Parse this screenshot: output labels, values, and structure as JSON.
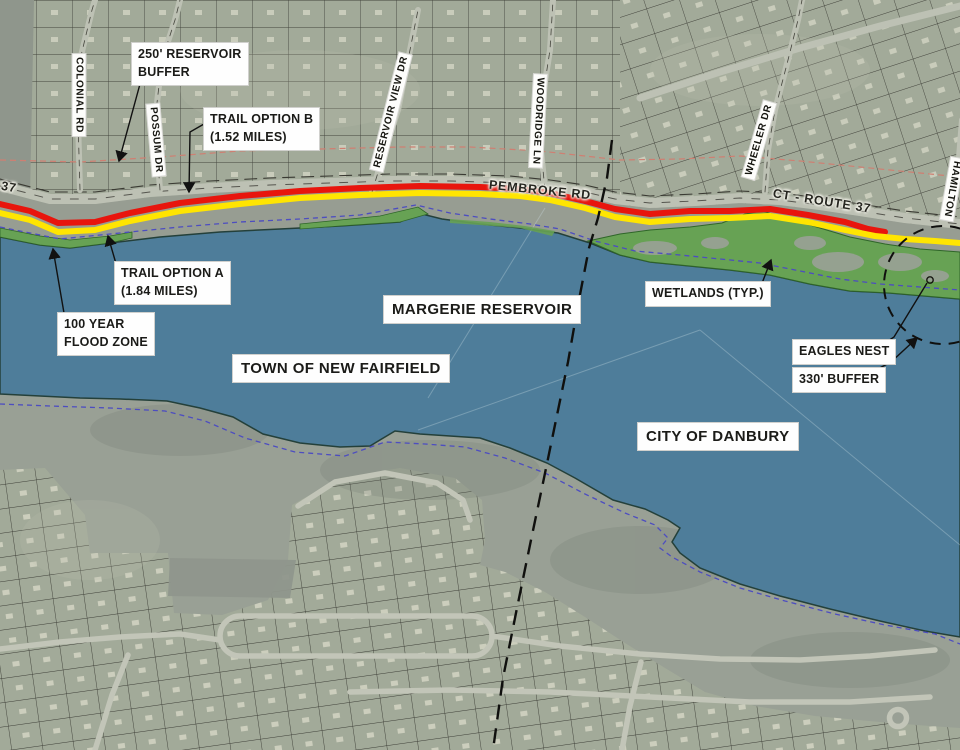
{
  "title": "Margerie Reservoir trail options map",
  "regions": {
    "reservoir": "MARGERIE RESERVOIR",
    "town": "TOWN OF NEW FAIRFIELD",
    "city": "CITY OF DANBURY"
  },
  "callouts": {
    "buffer250": {
      "line1": "250' RESERVOIR",
      "line2": "BUFFER"
    },
    "trail_b": {
      "line1": "TRAIL OPTION B",
      "line2": "(1.52 MILES)"
    },
    "trail_a": {
      "line1": "TRAIL OPTION A",
      "line2": "(1.84 MILES)"
    },
    "flood_zone": {
      "line1": "100 YEAR",
      "line2": "FLOOD ZONE"
    },
    "wetlands": {
      "label": "WETLANDS (TYP.)"
    },
    "eagles_nest": {
      "label": "EAGLES NEST"
    },
    "buffer330": {
      "label": "330' BUFFER"
    }
  },
  "road_labels": {
    "pembroke": "PEMBROKE RD",
    "route37": "CT - ROUTE 37",
    "route37_left": "37",
    "colonial": "COLONIAL RD",
    "possum": "POSSUM DR",
    "reservoir_view": "RESERVOIR VIEW DR",
    "woodridge": "WOODRIDGE LN",
    "wheeler": "WHEELER DR",
    "hamilton": "HAMILTON"
  },
  "map_colors": {
    "water": "#4e7d9a",
    "wetland_green": "#67a254",
    "trail_option_a_yellow": "#ffe501",
    "trail_option_b_red": "#e8150d",
    "flood_zone_dash_blue": "#4d4dc0",
    "reservoir_buffer_dash_pink": "#cf7f72"
  }
}
